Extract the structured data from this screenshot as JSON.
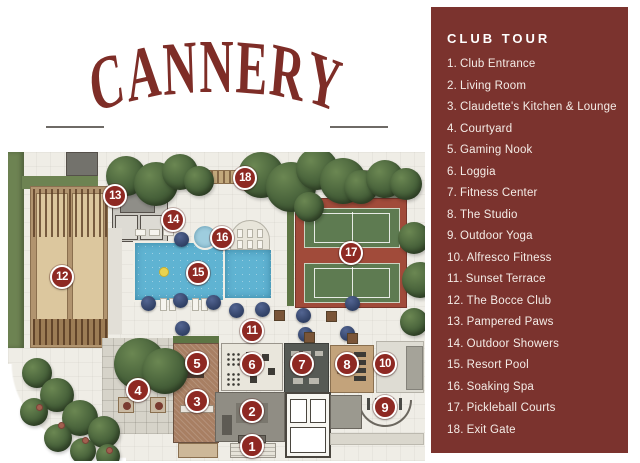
{
  "logo": {
    "the": "The",
    "cannery": "CANNERY",
    "club": "Club"
  },
  "sidebar": {
    "title": "CLUB TOUR",
    "items": [
      {
        "num": "1.",
        "label": "Club Entrance"
      },
      {
        "num": "2.",
        "label": "Living Room"
      },
      {
        "num": "3.",
        "label": "Claudette's Kitchen & Lounge"
      },
      {
        "num": "4.",
        "label": "Courtyard"
      },
      {
        "num": "5.",
        "label": "Gaming Nook"
      },
      {
        "num": "6.",
        "label": "Loggia"
      },
      {
        "num": "7.",
        "label": "Fitness Center"
      },
      {
        "num": "8.",
        "label": "The Studio"
      },
      {
        "num": "9.",
        "label": "Outdoor Yoga"
      },
      {
        "num": "10.",
        "label": "Alfresco Fitness"
      },
      {
        "num": "11.",
        "label": "Sunset Terrace"
      },
      {
        "num": "12.",
        "label": "The Bocce Club"
      },
      {
        "num": "13.",
        "label": "Pampered Paws"
      },
      {
        "num": "14.",
        "label": "Outdoor Showers"
      },
      {
        "num": "15.",
        "label": "Resort Pool"
      },
      {
        "num": "16.",
        "label": "Soaking Spa"
      },
      {
        "num": "17.",
        "label": "Pickleball Courts"
      },
      {
        "num": "18.",
        "label": "Exit Gate"
      }
    ]
  },
  "map": {
    "markers": [
      {
        "n": "1",
        "x": 244,
        "y": 294
      },
      {
        "n": "2",
        "x": 244,
        "y": 259
      },
      {
        "n": "3",
        "x": 189,
        "y": 249
      },
      {
        "n": "4",
        "x": 130,
        "y": 238
      },
      {
        "n": "5",
        "x": 189,
        "y": 211
      },
      {
        "n": "6",
        "x": 244,
        "y": 212
      },
      {
        "n": "7",
        "x": 294,
        "y": 212
      },
      {
        "n": "8",
        "x": 339,
        "y": 212
      },
      {
        "n": "9",
        "x": 377,
        "y": 255
      },
      {
        "n": "10",
        "x": 377,
        "y": 212
      },
      {
        "n": "11",
        "x": 244,
        "y": 179
      },
      {
        "n": "12",
        "x": 54,
        "y": 125
      },
      {
        "n": "13",
        "x": 107,
        "y": 44
      },
      {
        "n": "14",
        "x": 165,
        "y": 68
      },
      {
        "n": "15",
        "x": 190,
        "y": 121
      },
      {
        "n": "16",
        "x": 214,
        "y": 86
      },
      {
        "n": "17",
        "x": 343,
        "y": 101
      },
      {
        "n": "18",
        "x": 237,
        "y": 26
      }
    ]
  },
  "colors": {
    "sidebar_bg": "#7B332E",
    "sidebar_text": "#F4ECE7",
    "marker_bg": "#8E2923",
    "marker_ring": "#FFFFFF",
    "logo": "#7E2D27",
    "map_bg": "#EFEDE6",
    "pool": "#5FB3D2",
    "court_green": "#5E7B51",
    "court_surround": "#A14B3A",
    "tree": "#47613A",
    "umbrella": "#2F3F63",
    "bocce_tan": "#DCC79E"
  }
}
